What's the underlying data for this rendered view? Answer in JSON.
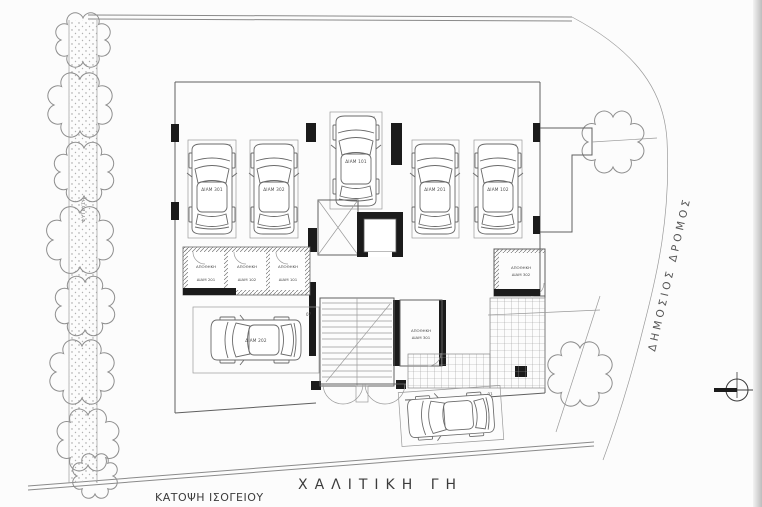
{
  "plan": {
    "title": "ΚΑΤΟΨΗ ΙΣΟΓΕΙΟΥ",
    "site_label": "ΧΑΛΙΤΙΚΗ ΓΗ",
    "road_label": "ΔΗΜΟΣΙΟΣ ΔΡΟΜΟΣ",
    "planting_label": "ΦΥΤΕΥΣΗ",
    "parking": {
      "stalls": [
        {
          "number": "06",
          "car_label": "ΔΙΑΜ 301"
        },
        {
          "number": "05",
          "car_label": "ΔΙΑΜ 302"
        },
        {
          "number": "04",
          "car_label": "ΔΙΑΜ 101"
        },
        {
          "number": "03",
          "car_label": "ΔΙΑΜ 201"
        },
        {
          "number": "02",
          "car_label": "ΔΙΑΜ 102"
        },
        {
          "number": "07",
          "car_label": "ΔΙΑΜ 202"
        },
        {
          "number": "01",
          "car_label": ""
        }
      ]
    },
    "storage_rooms": {
      "row": [
        {
          "type_label": "ΑΠΟΘΗΚΗ",
          "apt_label": "ΔΙΑΜ 201"
        },
        {
          "type_label": "ΑΠΟΘΗΚΗ",
          "apt_label": "ΔΙΑΜ 102"
        },
        {
          "type_label": "ΑΠΟΘΗΚΗ",
          "apt_label": "ΔΙΑΜ 101"
        }
      ],
      "core": {
        "type_label": "ΑΠΟΘΗΚΗ",
        "apt_label": "ΔΙΑΜ 301"
      },
      "east": {
        "type_label": "ΑΠΟΘΗΚΗ",
        "apt_label": "ΔΙΑΜ 302"
      }
    },
    "colors": {
      "paper": "#fcfcfc",
      "line": "#8a8a8a",
      "wall": "#1b1b1b",
      "text": "#4a4a4a"
    }
  }
}
